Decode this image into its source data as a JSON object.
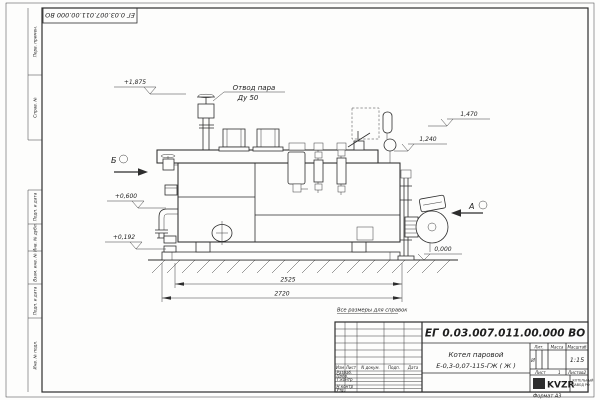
{
  "sheet": {
    "doc_number_top": "ЕГ 0.03.007.011.00.000 ВО",
    "reference_note": "Все размеры для справок",
    "format_label": "Формат А3"
  },
  "margin_labels": [
    "Перв. примен.",
    "Справ. №",
    "Подп. и дата",
    "Инв. № дубл.",
    "Взам. инв. №",
    "Подп. и дата",
    "Инв. № подл."
  ],
  "annotations": {
    "steam_outlet_1": "Отвод пара",
    "steam_outlet_2": "Ду 50",
    "elev_top": "+1,875",
    "elev_mid": "+0,600",
    "elev_low": "+0,192",
    "elev_right_top": "1,470",
    "elev_right_mid": "1,240",
    "elev_zero": "0,000",
    "dim_inner": "2525",
    "dim_outer": "2720",
    "view_b": "Б",
    "view_a": "А"
  },
  "title_block": {
    "doc_number": "ЕГ 0.03.007.011.00.000 ВО",
    "product_name_1": "Котел паровой",
    "product_name_2": "Е-0,3-0,07-115-ГЖ ( Ж )",
    "rev_cols": [
      "Изм",
      "Лист",
      "N докум.",
      "Подп.",
      "Дата"
    ],
    "roles": [
      "Разраб.",
      "Пров.",
      "Т.контр",
      "Н.контр",
      "Утв."
    ],
    "lit_label": "Лит.",
    "lit_value": "И",
    "mass_label": "Масса",
    "scale_label": "Масштаб",
    "scale_value": "1:15",
    "sheet_label": "Лист",
    "sheet_value": "1",
    "sheets_label": "Листов",
    "sheets_value": "2",
    "logo_text": "KVZR",
    "logo_caption_1": "КОТЕЛЬНЫЙ",
    "logo_caption_2": "ЗАВОД РФ"
  }
}
